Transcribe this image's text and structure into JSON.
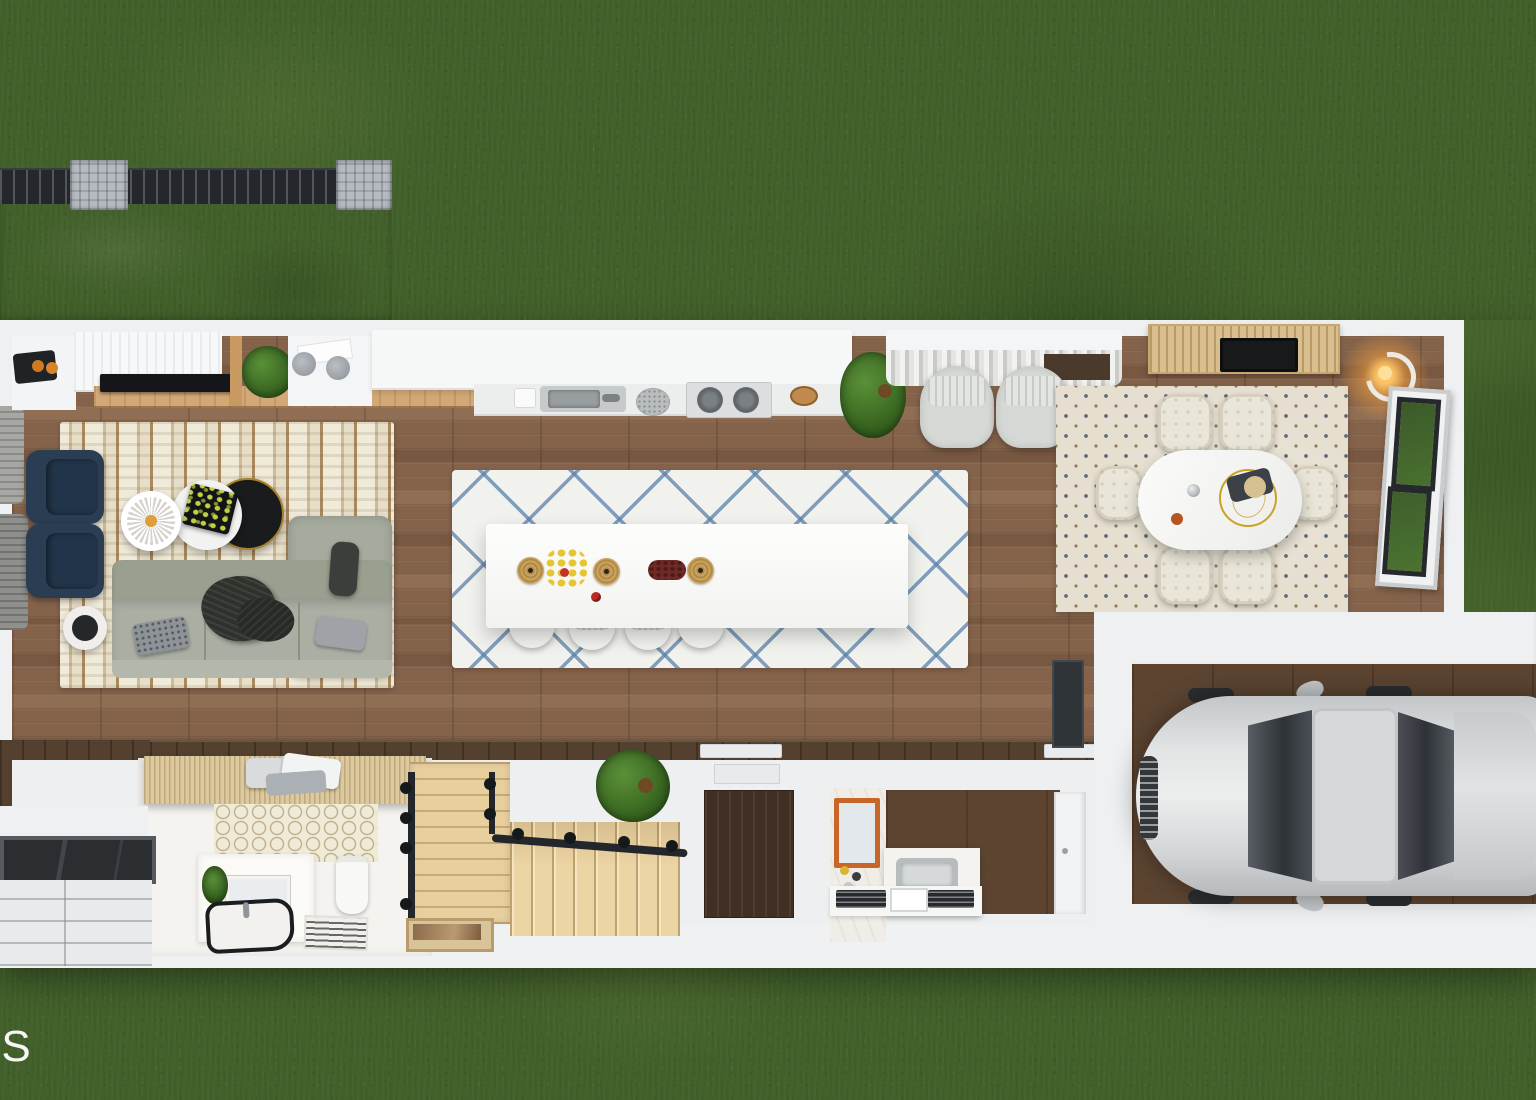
{
  "watermark": {
    "text": "AS",
    "visible_fragment": "S",
    "color": "#ffffff"
  },
  "scene": {
    "type": "floor-plan-3d-render",
    "view": "top-down dollhouse cutaway",
    "setting": "long narrow single-story home with rear deck and attached garage on a green lawn"
  },
  "palette": {
    "grass": "#42602a",
    "house_wall": "#eef0f2",
    "wood_floor": "#85634b",
    "garage_floor": "#5c4431",
    "patio_concrete": "#7f868e",
    "railing_dark": "#24272b",
    "accent_navy": "#2c3e53",
    "island_rug_blue": "#6f94b5",
    "stair_wood": "#e9d2a0",
    "mirror_frame_orange": "#c8662a",
    "lamp_glow": "#f5a93b",
    "car_silver": "#d6d8da"
  },
  "rooms": [
    {
      "name": "deck-patio",
      "objects": [
        "concrete-slab",
        "slatted-railing",
        "stone-post",
        "stone-post"
      ]
    },
    {
      "name": "living-room",
      "objects": [
        "striped-rug",
        "gray-sectional-sofa",
        "throw-blanket",
        "patterned-pillow",
        "gray-pillow",
        "navy-armchair",
        "navy-armchair",
        "spoke-coffee-table",
        "white-coffee-table",
        "black-gold-coffee-table",
        "round-side-table",
        "tv-console",
        "tv",
        "wood-ledge",
        "potted-plant",
        "desk-with-accessories",
        "corner-tray-with-fruit",
        "gray-pouf",
        "gray-pouf"
      ]
    },
    {
      "name": "kitchen",
      "objects": [
        "upper-cabinets",
        "counter",
        "double-sink",
        "colander",
        "cooktop-two-burners",
        "wood-bowl",
        "island",
        "diamond-lattice-rug",
        "bar-stool",
        "bar-stool",
        "bar-stool",
        "bar-stool",
        "placemat",
        "placemat",
        "placemat",
        "fruit-bowl",
        "berry",
        "red-dish",
        "potted-plant"
      ]
    },
    {
      "name": "sitting-nook",
      "objects": [
        "window-with-curtains",
        "upholstered-chair",
        "upholstered-chair",
        "potted-plant"
      ]
    },
    {
      "name": "dining-room",
      "objects": [
        "patterned-rug",
        "oval-white-table",
        "gold-ring-centerpiece",
        "dining-chair",
        "dining-chair",
        "dining-chair",
        "dining-chair",
        "dining-chair",
        "dining-chair",
        "dark-console",
        "wood-slat-canopy",
        "skylight",
        "glowing-floor-lamp",
        "open-glass-door"
      ]
    },
    {
      "name": "bathroom",
      "objects": [
        "slatted-roof",
        "towel-stack",
        "hex-tile-wall",
        "vanity",
        "mirror",
        "black-rim-basin",
        "toilet",
        "striped-bath-mat",
        "small-plant"
      ]
    },
    {
      "name": "staircase",
      "objects": [
        "wood-landing",
        "wood-treads",
        "black-railing",
        "railing-finials",
        "doormat",
        "potted-plant"
      ]
    },
    {
      "name": "entry",
      "objects": [
        "dark-wood-floor",
        "door-sill",
        "porch-canopy",
        "paver-walkway"
      ]
    },
    {
      "name": "laundry-powder-room",
      "objects": [
        "orange-frame-mirror",
        "marble-wall",
        "utility-sink",
        "base-cabinets",
        "vent-grille",
        "vent-grille",
        "closet-door",
        "dark-wall-panel"
      ]
    },
    {
      "name": "garage",
      "objects": [
        "silver-car",
        "windshield",
        "roof",
        "rear-glass",
        "side-mirror",
        "side-mirror",
        "wheels"
      ]
    }
  ]
}
